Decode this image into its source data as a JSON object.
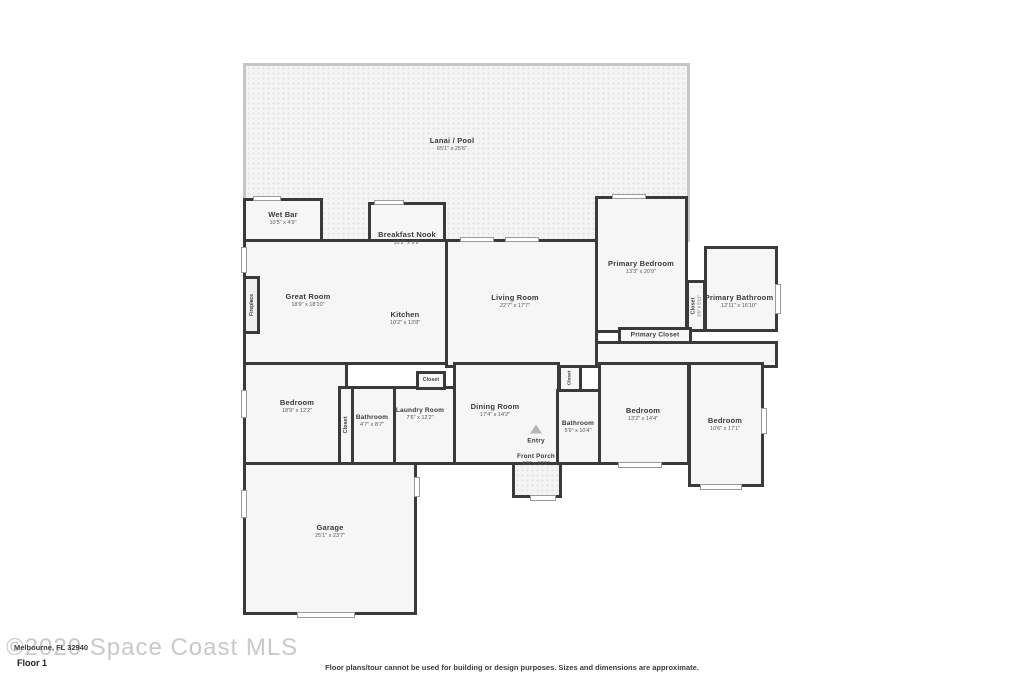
{
  "colors": {
    "wall": "#3a3a3a",
    "room_fill": "#f6f6f6",
    "patio_fill": "#f4f4f4",
    "patio_wall": "#c6c6c6",
    "text": "#3a3a3a",
    "dims": "#5a5a5a",
    "watermark": "#c9c9c9",
    "win_border": "#9a9a9a"
  },
  "rooms": {
    "lanai": {
      "name": "Lanai / Pool",
      "dims": "65'1\" x 25'6\""
    },
    "wet_bar": {
      "name": "Wet Bar",
      "dims": "10'5\" x 4'9\""
    },
    "breakfast_nook": {
      "name": "Breakfast Nook",
      "dims": "10'2\" x 9'9\""
    },
    "great_room": {
      "name": "Great Room",
      "dims": "18'9\" x 18'10\""
    },
    "kitchen": {
      "name": "Kitchen",
      "dims": "10'2\" x 13'8\""
    },
    "living_room": {
      "name": "Living Room",
      "dims": "22'7\" x 17'7\""
    },
    "primary_bedroom": {
      "name": "Primary Bedroom",
      "dims": "13'3\" x 20'9\""
    },
    "primary_bath_closet": {
      "name": "Closet",
      "dims": "2'6\" x 5'11\""
    },
    "primary_bathroom": {
      "name": "Primary Bathroom",
      "dims": "12'11\" x 16'10\""
    },
    "primary_closet": {
      "name": "Primary Closet",
      "dims": ""
    },
    "bedroom_left": {
      "name": "Bedroom",
      "dims": "18'9\" x 12'2\""
    },
    "closet_left": {
      "name": "Closet",
      "dims": ""
    },
    "bathroom_left": {
      "name": "Bathroom",
      "dims": "4'7\" x 8'7\""
    },
    "laundry_room": {
      "name": "Laundry Room",
      "dims": "7'6\" x 12'2\""
    },
    "closet_laundry": {
      "name": "Closet",
      "dims": ""
    },
    "dining_room": {
      "name": "Dining Room",
      "dims": "17'4\" x 14'2\""
    },
    "closet_hall": {
      "name": "Closet",
      "dims": ""
    },
    "bathroom_hall": {
      "name": "Bathroom",
      "dims": "5'9\" x 10'4\""
    },
    "entry": {
      "name": "Entry",
      "dims": ""
    },
    "front_porch": {
      "name": "Front Porch",
      "dims": "6'8\" x 10'5\""
    },
    "bedroom_mid": {
      "name": "Bedroom",
      "dims": "13'2\" x 14'4\""
    },
    "bedroom_right": {
      "name": "Bedroom",
      "dims": "10'6\" x 17'1\""
    },
    "garage": {
      "name": "Garage",
      "dims": "25'1\" x 23'7\""
    },
    "fireplace": {
      "name": "Fireplace",
      "dims": ""
    }
  },
  "watermark": {
    "text": "©2020 Space Coast MLS",
    "address": "Melbourne, FL 32940"
  },
  "footer": {
    "floor_label": "Floor 1",
    "disclaimer": "Floor plans/tour cannot be used for building or design purposes. Sizes and dimensions are approximate."
  }
}
